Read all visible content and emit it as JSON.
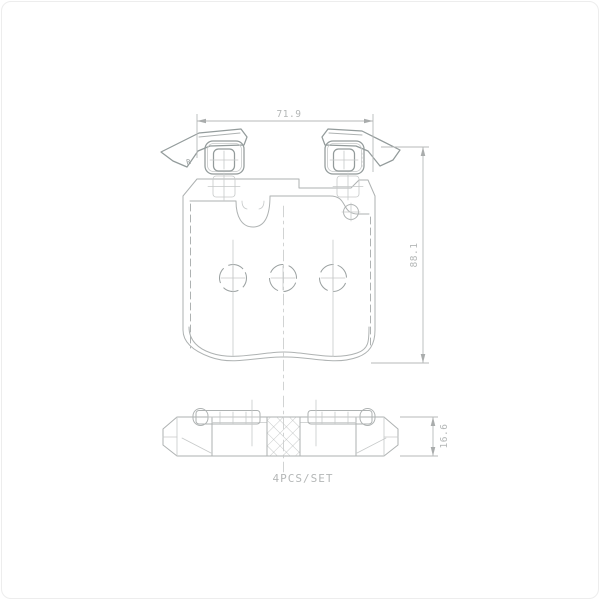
{
  "drawing": {
    "dimension_labels": {
      "width": "71.9",
      "height": "88.1",
      "thickness": "16.6"
    },
    "set_label": "4PCS/SET",
    "stamp": "R",
    "colors": {
      "background": "#ffffff",
      "line_bold": "#939b9b",
      "line": "#aeb2b2",
      "line_faint": "#c6c9c9",
      "dimension": "#b7baba",
      "text": "#b4b7b7"
    }
  }
}
